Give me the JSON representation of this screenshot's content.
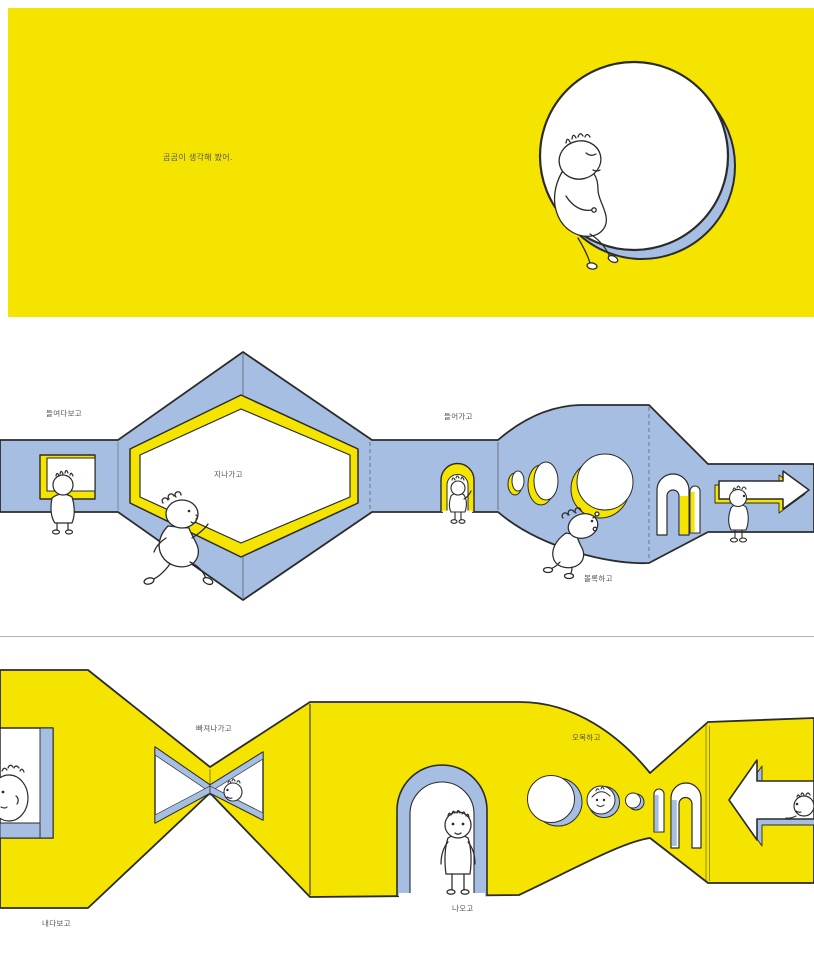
{
  "colors": {
    "yellow": "#F4E400",
    "blue": "#A6BEE1",
    "paper": "#FFFFFF",
    "ink": "#2B2B2B",
    "label_text": "#555555",
    "divider": "#B3B3B3"
  },
  "panels": {
    "top": {
      "caption": "곰곰이 생각해 봤어."
    },
    "middle": {
      "labels": {
        "peek_in": "들여다보고",
        "pass_through": "지나가고",
        "go_in": "들어가고",
        "convex": "볼록하고"
      }
    },
    "bottom": {
      "labels": {
        "slip_out": "빠져나가고",
        "look_out": "내다보고",
        "come_out": "나오고",
        "concave": "오목하고"
      }
    }
  }
}
